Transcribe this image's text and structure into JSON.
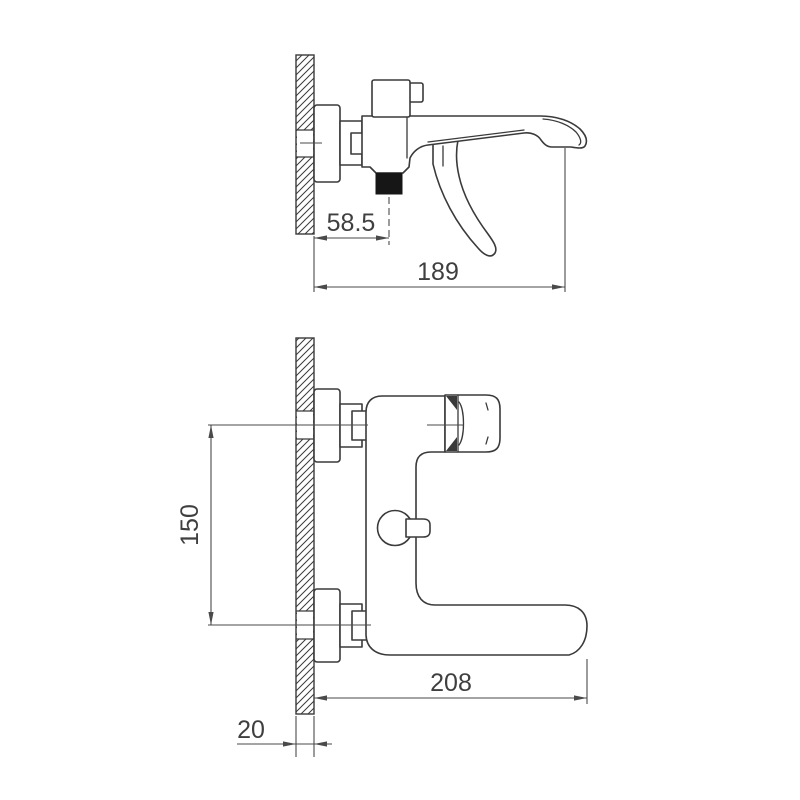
{
  "title": "bath-shower-mixer-technical-drawing",
  "colors": {
    "background": "#ffffff",
    "line": "#3a3a3a",
    "dimension_line": "#4a4a4a",
    "text": "#3f3f3f",
    "outlet_fill": "#161616"
  },
  "dimensions": {
    "wall_to_shower_outlet": "58.5",
    "wall_to_spout_tip": "189",
    "port_spacing": "150",
    "wall_to_body_end": "208",
    "wall_thickness": "20"
  }
}
